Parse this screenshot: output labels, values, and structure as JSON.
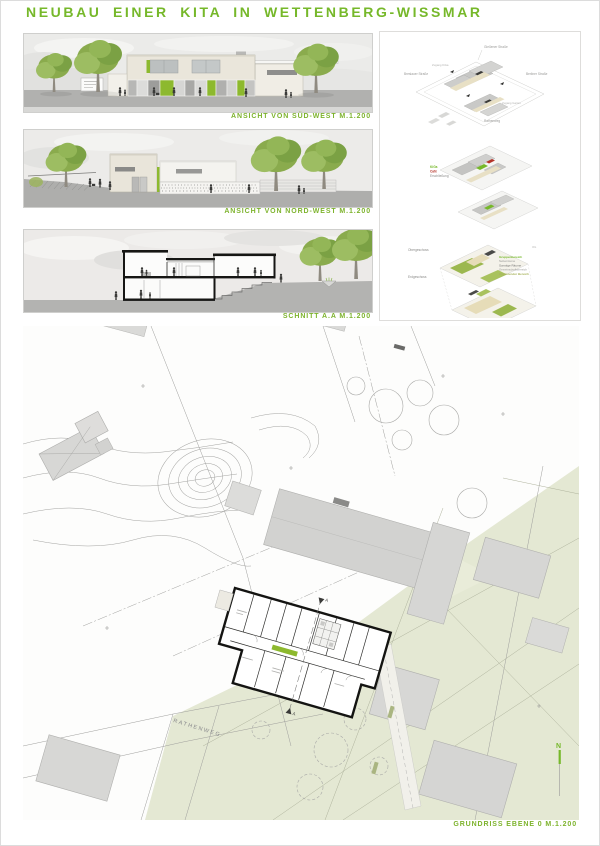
{
  "page": {
    "title": "NEUBAU EINER KITA IN WETTENBERG-WISSMAR",
    "accent_color": "#76b82a"
  },
  "figures": {
    "elevation_sw": {
      "caption": "ANSICHT VON SÜD-WEST M.1.200"
    },
    "elevation_nw": {
      "caption": "ANSICHT VON NORD-WEST M.1.200"
    },
    "section": {
      "caption": "SCHNITT A.A M.1.200"
    },
    "site_plan": {
      "caption": "GRUNDRISS EBENE 0 M.1.200",
      "street_label": "RATHENWEG",
      "north_label": "N",
      "section_mark": "A"
    }
  },
  "diagrams": {
    "context": {
      "street_top": "Gießener Straße",
      "street_left": "Breslauer Straße",
      "street_right": "Berliner Straße",
      "street_bottom": "Rathenweg",
      "note_upper": "Zugang KiGa",
      "note_lower": "Zugang Garten"
    },
    "uses": {
      "legend": [
        {
          "label": "KiGa",
          "color": "#76b82a"
        },
        {
          "label": "Café",
          "color": "#b5342a"
        },
        {
          "label": "Erschließung",
          "color": "#8a8a88"
        }
      ]
    },
    "levels": {
      "upper_label": "Obergeschoss",
      "lower_label": "Erdgeschoss",
      "upper_tag": "OG",
      "lower_tag": "EG",
      "legend": [
        {
          "label": "Gruppenbereich",
          "color": "#76b82a"
        },
        {
          "label": "Nebenräume",
          "color": "#9a9a98"
        },
        {
          "label": "Sonstige Räume",
          "color": "#6f6f6d"
        },
        {
          "label": "Gemeinschaftsbereich",
          "color": "#9a9a98"
        },
        {
          "label": "Ergänzender Bereich",
          "color": "#a9b45e"
        }
      ]
    }
  }
}
